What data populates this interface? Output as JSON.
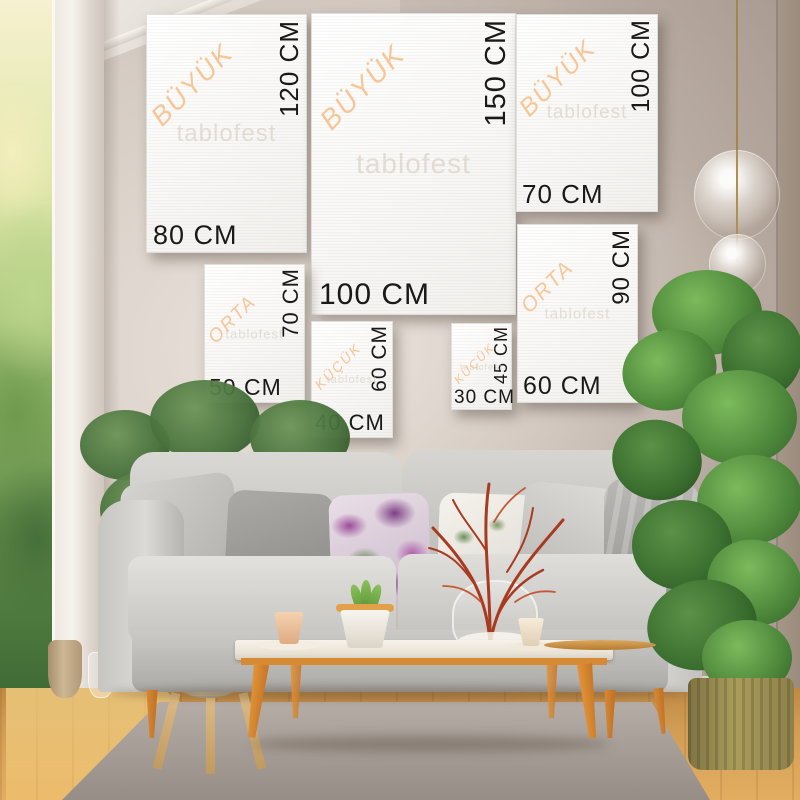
{
  "brand": {
    "watermark": "tablofest"
  },
  "palette": {
    "category_label": "#f7c493",
    "dimension_text": "#1b1918",
    "canvas_white": "#f8f7f5"
  },
  "size_guide": {
    "canvases": [
      {
        "category": "BÜYÜK",
        "width_label": "80 CM",
        "height_label": "120 CM"
      },
      {
        "category": "BÜYÜK",
        "width_label": "100 CM",
        "height_label": "150 CM"
      },
      {
        "category": "BÜYÜK",
        "width_label": "70 CM",
        "height_label": "100 CM"
      },
      {
        "category": "ORTA",
        "width_label": "50 CM",
        "height_label": "70 CM"
      },
      {
        "category": "KÜÇÜK",
        "width_label": "40 CM",
        "height_label": "60 CM"
      },
      {
        "category": "KÜÇÜK",
        "width_label": "30 CM",
        "height_label": "45 CM"
      },
      {
        "category": "ORTA",
        "width_label": "60 CM",
        "height_label": "90 CM"
      }
    ]
  }
}
